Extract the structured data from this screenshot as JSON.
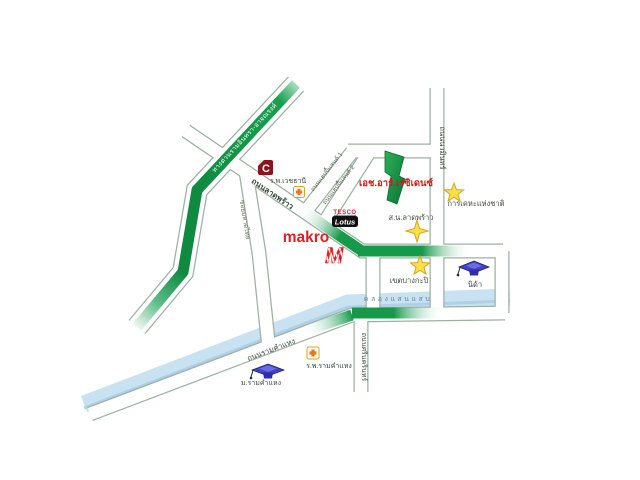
{
  "map_title": "H.R. Residence location map",
  "roads": {
    "expressway": "ทางด่วนรามอินทรา-อาจณรงค์",
    "latphrao": "ถนนลาดพร้าว",
    "happyland1": "ถนนแฮปปี้แลนด์ 1",
    "happyland2": "ถนนแฮปปี้แลนด์ 2",
    "nawamin": "ถนนนวมินทร์",
    "srinakarin": "ถนนศรีนครินทร์",
    "ramkhamhaeng": "ถนนรามคำแหง",
    "mahatthai": "ซอยมหาดไทย",
    "canal": "คลองแสนแสบ"
  },
  "places": {
    "residence": "เอช.อาร์.เรซิเดนซ์",
    "vejthani_hospital": "ร.พ.เวชธานี",
    "latphrao_police": "ส.น.ลาดพร้าว",
    "national_housing": "การเคหะแห่งชาติ",
    "bangkapi_district": "เขตบางกะปิ",
    "nida": "นิด้า",
    "ram_hospital": "ร.พ.รามคำแหง",
    "ram_university": "ม.รามคำแหง"
  },
  "logos": {
    "makro": "makro",
    "makro_m": "M",
    "tesco": "TESCO",
    "lotus": "Lotus",
    "central_c": "C"
  },
  "colors": {
    "route_green": "#169a4a",
    "route_green_dark": "#0f8a40",
    "canal_blue": "#c9e2f2",
    "star_yellow": "#f8e14b",
    "star_outline": "#dba21d",
    "makro_red": "#e02028",
    "residence_red": "#cc1a1a",
    "road_casing": "#9db0a2",
    "c_logo_maroon": "#8a1418",
    "grad_cap_blue": "#4343c8",
    "cross_orange": "#e87820",
    "canal_text_blue": "#6888a8"
  }
}
